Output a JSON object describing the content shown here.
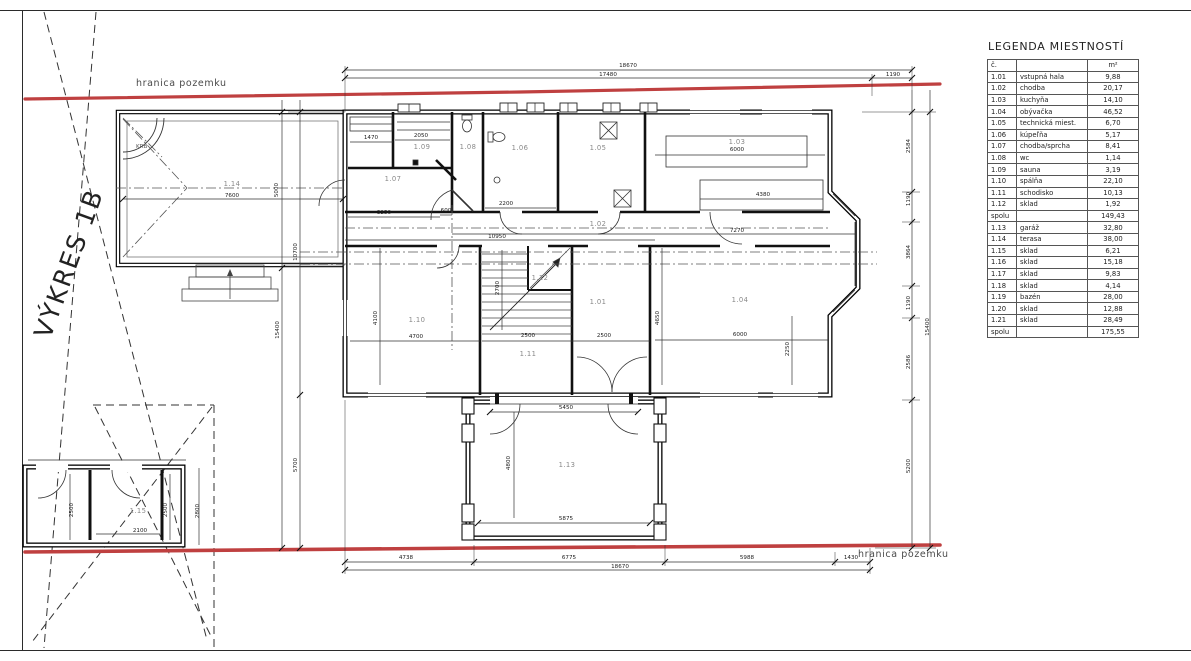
{
  "sheet": {
    "drawing_label": "VÝKRES 1B",
    "boundary_label_top": "hranica pozemku",
    "boundary_label_bottom": "hranica pozemku",
    "fireplace_label": "KRB",
    "boundary_color": "#bf4040"
  },
  "legend": {
    "title": "LEGENDA MIESTNOSTÍ",
    "headers": {
      "number": "č.",
      "name": "",
      "area": "m²"
    },
    "rows": [
      {
        "number": "1.01",
        "name": "vstupná hala",
        "area": "9,88",
        "total": false
      },
      {
        "number": "1.02",
        "name": "chodba",
        "area": "20,17",
        "total": false
      },
      {
        "number": "1.03",
        "name": "kuchyňa",
        "area": "14,10",
        "total": false
      },
      {
        "number": "1.04",
        "name": "obývačka",
        "area": "46,52",
        "total": false
      },
      {
        "number": "1.05",
        "name": "technická miest.",
        "area": "6,70",
        "total": false
      },
      {
        "number": "1.06",
        "name": "kúpeľňa",
        "area": "5,17",
        "total": false
      },
      {
        "number": "1.07",
        "name": "chodba/sprcha",
        "area": "8,41",
        "total": false
      },
      {
        "number": "1.08",
        "name": "wc",
        "area": "1,14",
        "total": false
      },
      {
        "number": "1.09",
        "name": "sauna",
        "area": "3,19",
        "total": false
      },
      {
        "number": "1.10",
        "name": "spálňa",
        "area": "22,10",
        "total": false
      },
      {
        "number": "1.11",
        "name": "schodisko",
        "area": "10,13",
        "total": false
      },
      {
        "number": "1.12",
        "name": "sklad",
        "area": "1,92",
        "total": false
      },
      {
        "number": "spolu",
        "name": "",
        "area": "149,43",
        "total": true
      },
      {
        "number": "1.13",
        "name": "garáž",
        "area": "32,80",
        "total": false
      },
      {
        "number": "1.14",
        "name": "terasa",
        "area": "38,00",
        "total": false
      },
      {
        "number": "1.15",
        "name": "sklad",
        "area": "6,21",
        "total": false
      },
      {
        "number": "1.16",
        "name": "sklad",
        "area": "15,18",
        "total": false
      },
      {
        "number": "1.17",
        "name": "sklad",
        "area": "9,83",
        "total": false
      },
      {
        "number": "1.18",
        "name": "sklad",
        "area": "4,14",
        "total": false
      },
      {
        "number": "1.19",
        "name": "bazén",
        "area": "28,00",
        "total": false
      },
      {
        "number": "1.20",
        "name": "sklad",
        "area": "12,88",
        "total": false
      },
      {
        "number": "1.21",
        "name": "sklad",
        "area": "28,49",
        "total": false
      },
      {
        "number": "spolu",
        "name": "",
        "area": "175,55",
        "total": true
      }
    ]
  },
  "rooms": {
    "r101": "1.01",
    "r102": "1.02",
    "r103": "1.03",
    "r104": "1.04",
    "r105": "1.05",
    "r106": "1.06",
    "r107": "1.07",
    "r108": "1.08",
    "r109": "1.09",
    "r110": "1.10",
    "r111": "1.11",
    "r112": "1.12",
    "r113": "1.13",
    "r114": "1.14",
    "r115": "1.15"
  },
  "dims": [
    "18670",
    "17480",
    "1190",
    "7600",
    "5000",
    "10700",
    "15400",
    "5700",
    "1470",
    "2050",
    "3250",
    "600",
    "2200",
    "6000",
    "4380",
    "7270",
    "10950",
    "4700",
    "4100",
    "2700",
    "2500",
    "2500",
    "6000",
    "4650",
    "2250",
    "5450",
    "4800",
    "5875",
    "4738",
    "6775",
    "18670",
    "5988",
    "1430",
    "2584",
    "1190",
    "3864",
    "1190",
    "2586",
    "5200",
    "15400",
    "2500",
    "2100",
    "2500",
    "2800"
  ]
}
